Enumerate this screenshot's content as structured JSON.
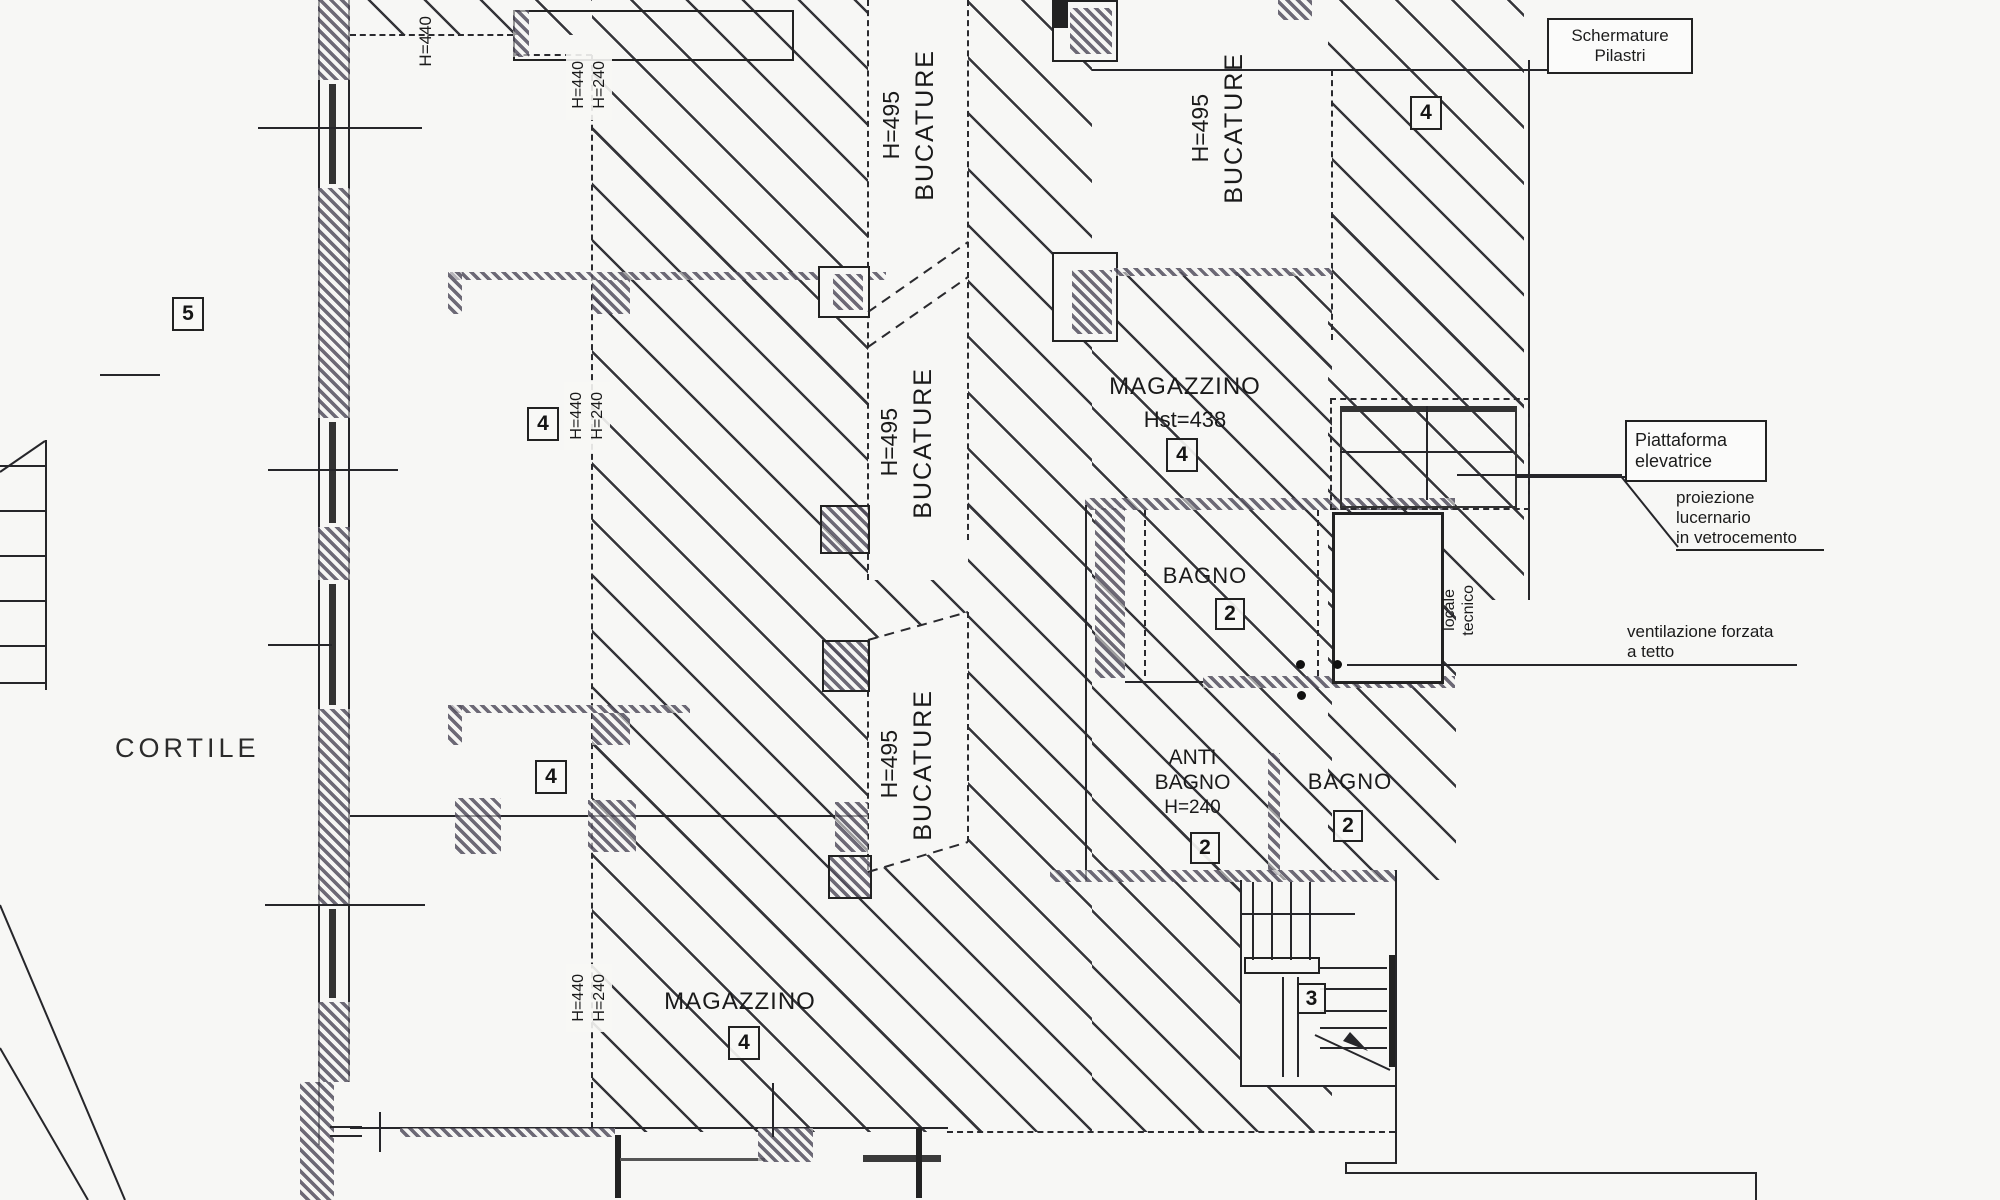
{
  "plan": {
    "courtyard_label": "CORTILE",
    "bucature": {
      "height": "H=495",
      "label": "BUCATURE"
    },
    "heights": {
      "h440": "H=440",
      "h240": "H=240"
    },
    "rooms": {
      "magazzino_main": {
        "name": "MAGAZZINO",
        "height_note": "Hst=438",
        "tag": "4"
      },
      "magazzino_lower": {
        "name": "MAGAZZINO",
        "tag": "4"
      },
      "bagno_upper": {
        "name": "BAGNO",
        "tag": "2"
      },
      "antibagno": {
        "line1": "ANTI",
        "line2": "BAGNO",
        "height_note": "H=240",
        "tag": "2"
      },
      "bagno_lower": {
        "name": "BAGNO",
        "tag": "2"
      },
      "locale_tecnico": {
        "line1": "locale",
        "line2": "tecnico"
      }
    },
    "zone_tags": {
      "cortile_zone": "5",
      "room_upper": "4",
      "room_lower": "4",
      "schermature_zone": "4",
      "stairs": "3"
    },
    "callouts": {
      "schermature": "Schermature Pilastri",
      "piattaforma": {
        "line1": "Piattaforma",
        "line2": "elevatrice"
      },
      "proiezione": {
        "line1": "proiezione",
        "line2": "lucernario",
        "line3": "in vetrocemento"
      },
      "ventilazione": {
        "line1": "ventilazione forzata",
        "line2": "a tetto"
      }
    }
  }
}
